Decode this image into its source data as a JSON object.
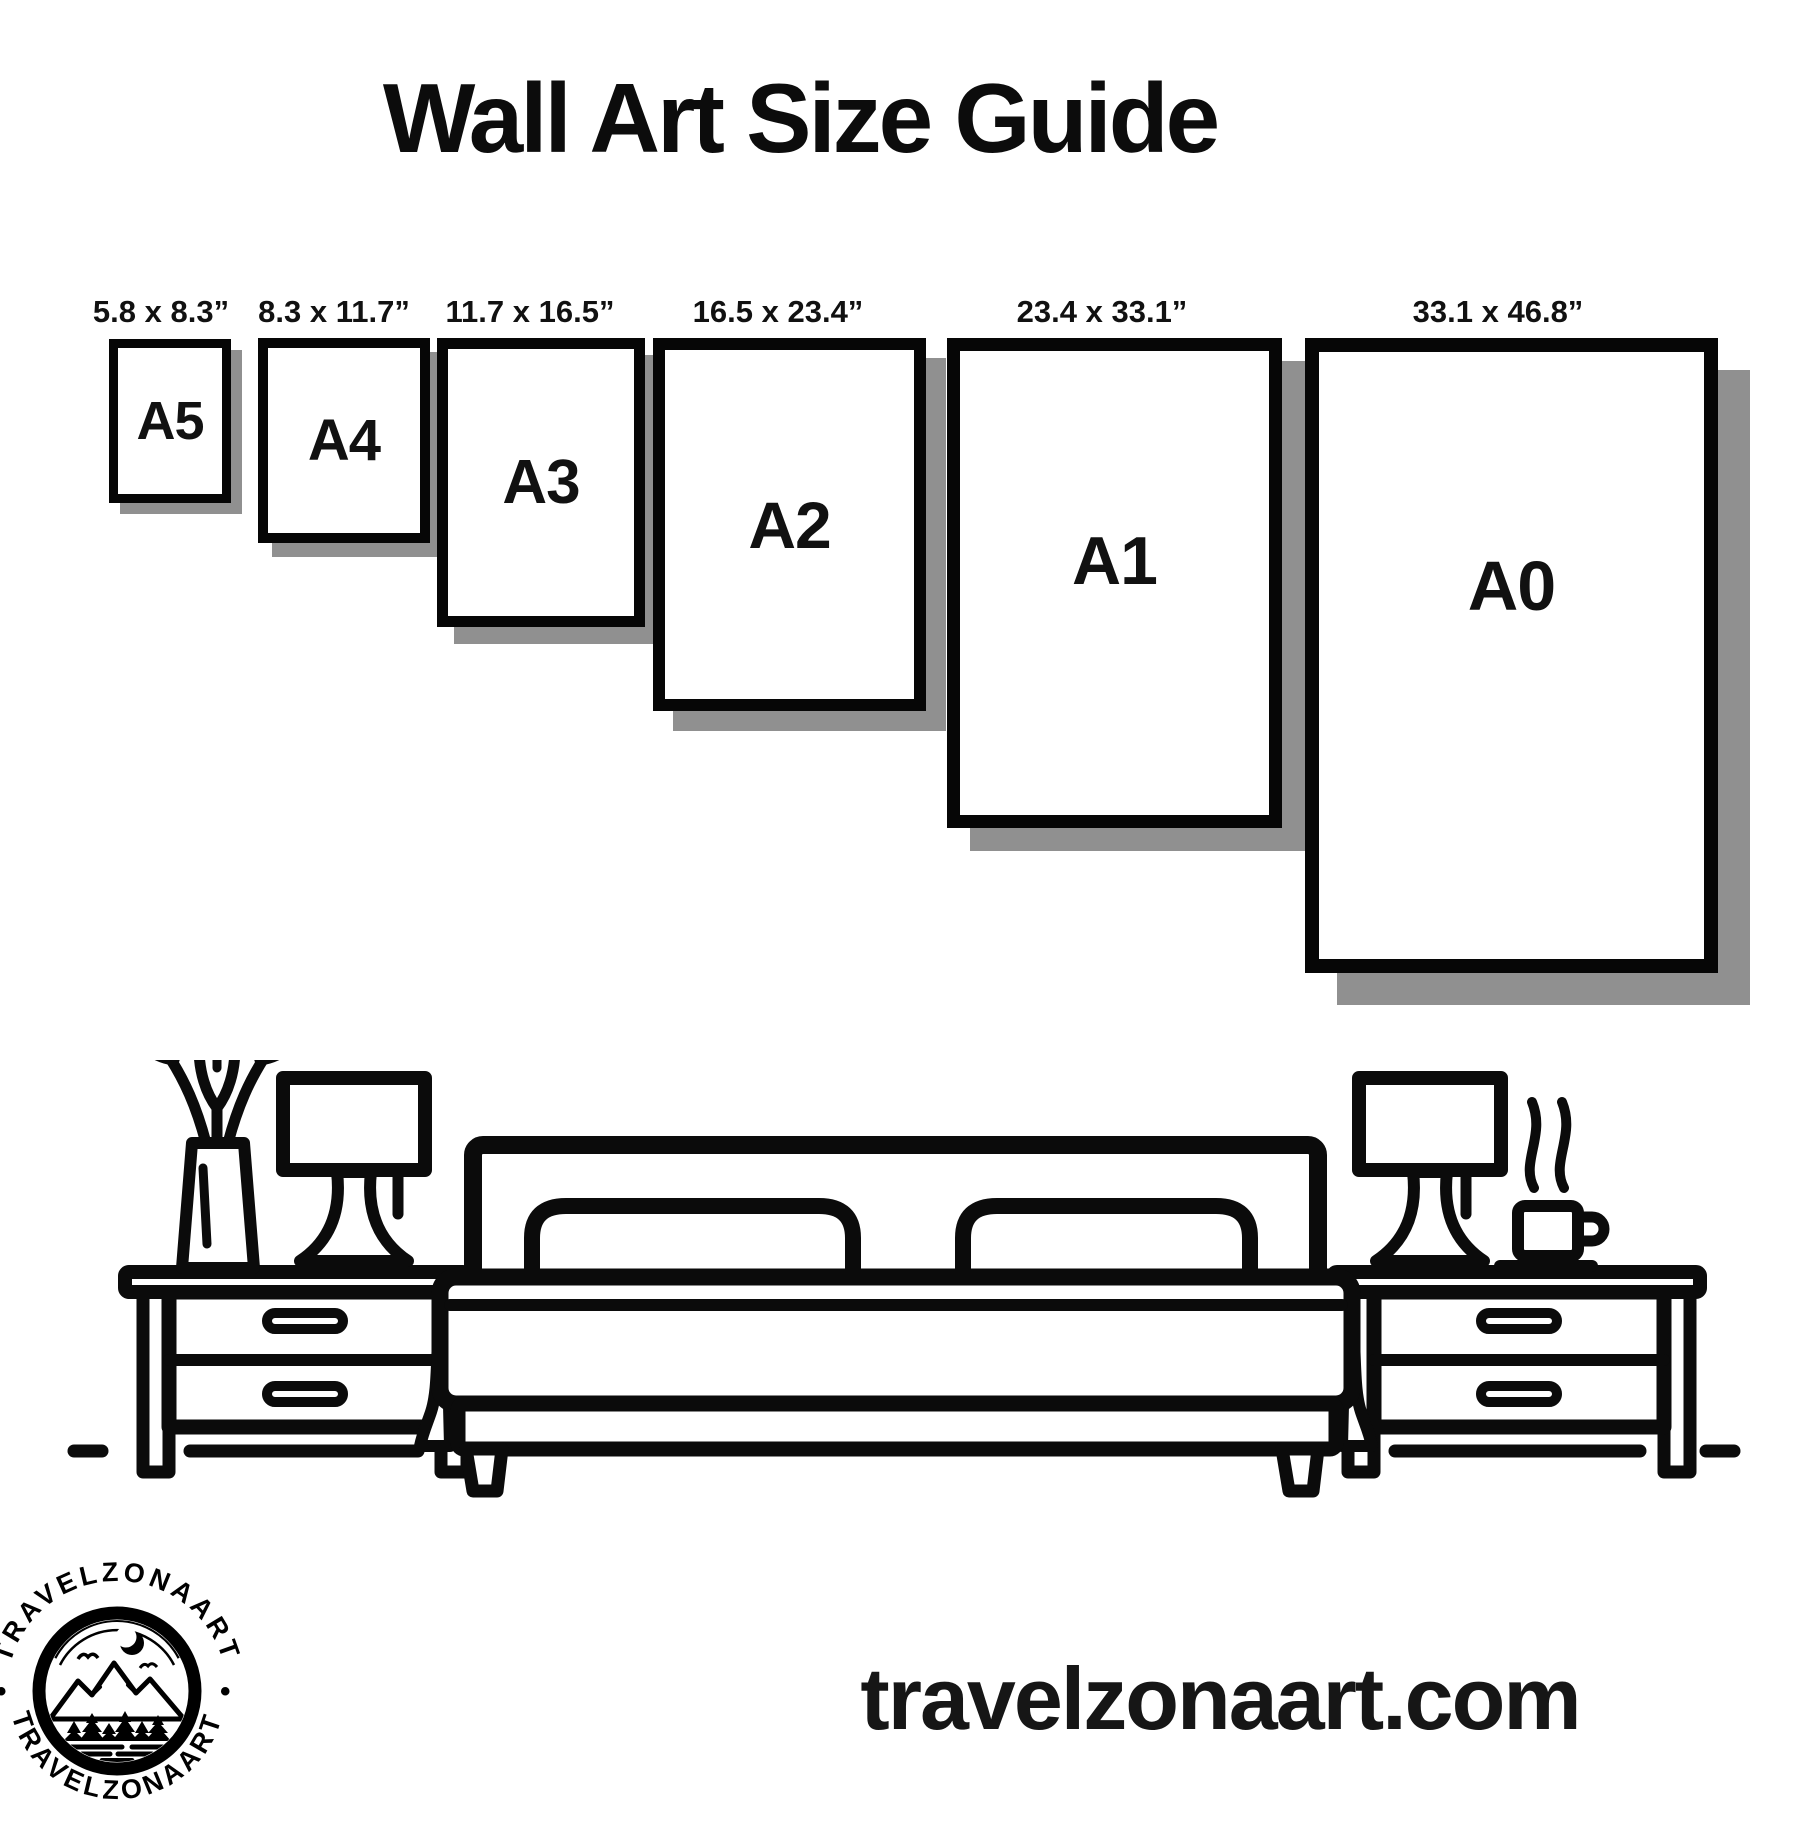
{
  "title": "Wall Art Size Guide",
  "frames": [
    {
      "id": "a5",
      "label": "A5",
      "dims": "5.8 x 8.3”"
    },
    {
      "id": "a4",
      "label": "A4",
      "dims": "8.3 x 11.7”"
    },
    {
      "id": "a3",
      "label": "A3",
      "dims": "11.7 x 16.5”"
    },
    {
      "id": "a2",
      "label": "A2",
      "dims": "16.5 x 23.4”"
    },
    {
      "id": "a1",
      "label": "A1",
      "dims": "23.4 x 33.1”"
    },
    {
      "id": "a0",
      "label": "A0",
      "dims": "33.1 x 46.8”"
    }
  ],
  "logo": {
    "brand": "TRAVELZONAART",
    "separator": "•"
  },
  "footer": {
    "website": "travelzonaart.com"
  },
  "colors": {
    "ink": "#000000",
    "frame_shadow": "#909090",
    "background": "#ffffff"
  }
}
